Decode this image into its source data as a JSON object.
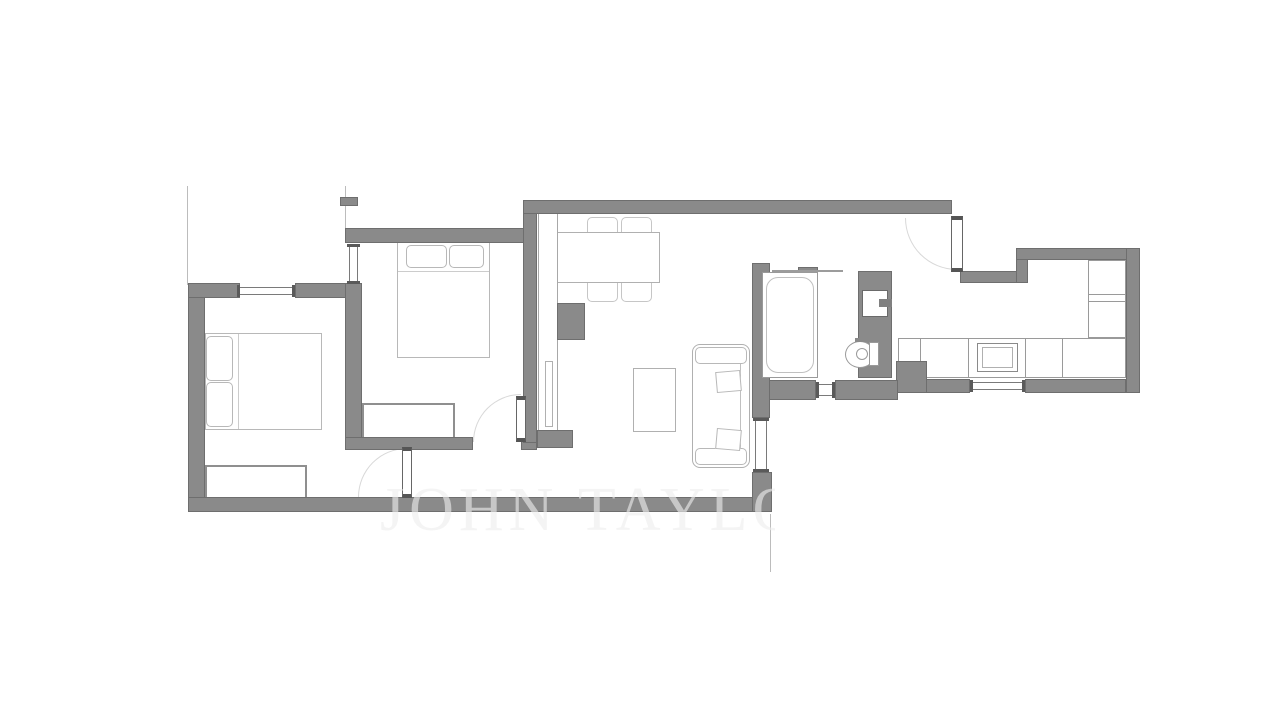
{
  "watermark": {
    "text": "JOHN TAYLOR",
    "visible_text": "JOHN TAYL"
  },
  "palette": {
    "background": "#ffffff",
    "wall_fill": "#8a8a8a",
    "wall_edge": "#6e6e6e",
    "furniture_outline": "#b8b8b8",
    "fixture_outline": "#9a9a9a",
    "window_frame": "#5a5a5a",
    "door_arc": "#d8d8d8",
    "boundary_line": "#bcbcbc",
    "watermark_color": "rgba(237,237,237,0.62)"
  },
  "plan": {
    "figure_type": "apartment-floor-plan",
    "rooms": [
      {
        "name": "bedroom-1",
        "furniture": [
          "double-bed",
          "two-pillows",
          "wardrobe"
        ],
        "openings": [
          "window-top-wall",
          "door-to-hallway"
        ]
      },
      {
        "name": "bedroom-2",
        "furniture": [
          "double-bed",
          "two-pillows",
          "wardrobe"
        ],
        "openings": [
          "window-left-wall",
          "door-to-hallway"
        ]
      },
      {
        "name": "living-dining-room",
        "furniture": [
          "dining-table",
          "four-chairs",
          "tall-cabinet",
          "masonry-column",
          "coffee-table",
          "sofa"
        ],
        "openings": [
          "window-right-wall",
          "opening-to-entry-hall"
        ]
      },
      {
        "name": "hallway",
        "furniture": [],
        "openings": [
          "door-living-side"
        ]
      },
      {
        "name": "bathroom",
        "furniture": [
          "bathtub",
          "shower-screen",
          "washbasin",
          "toilet"
        ],
        "openings": [
          "small-window-bottom-wall"
        ]
      },
      {
        "name": "kitchen",
        "furniture": [
          "l-shaped-counter",
          "cooktop-appliance",
          "tall-units"
        ],
        "openings": [
          "window-bottom-wall",
          "entrance-door"
        ]
      }
    ]
  }
}
